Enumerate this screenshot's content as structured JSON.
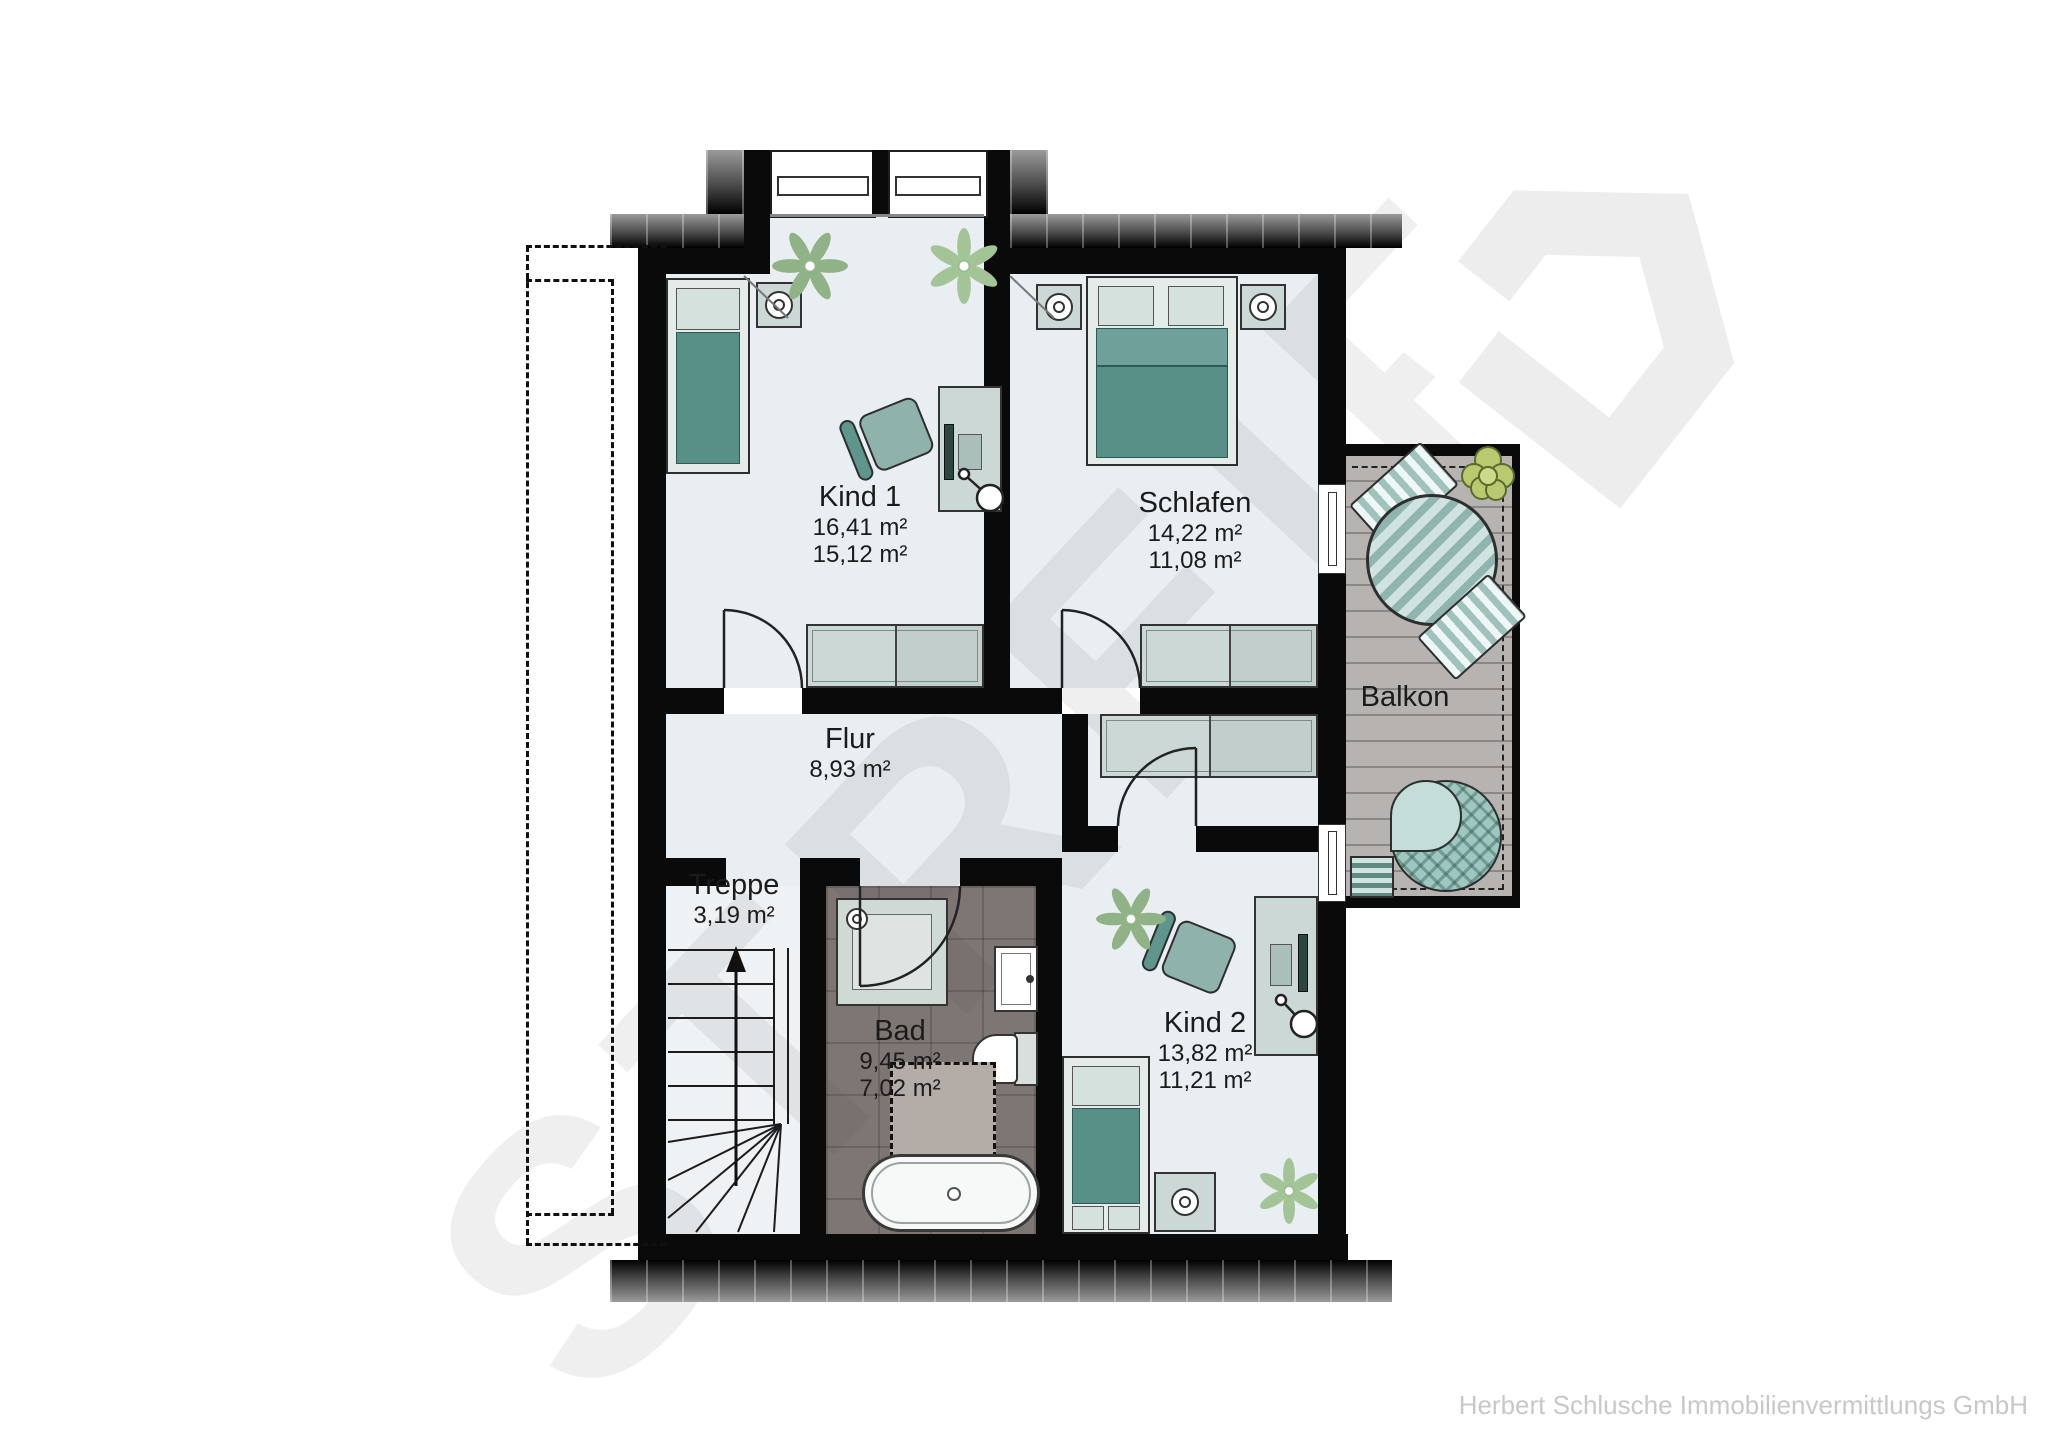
{
  "watermark": {
    "text": "STREIF"
  },
  "footer": {
    "company": "Herbert Schlusche Immobilienvermittlungs GmbH"
  },
  "rooms": [
    {
      "id": "kind1",
      "name": "Kind 1",
      "area_total": "16,41 m²",
      "area_living": "15,12 m²"
    },
    {
      "id": "schlafen",
      "name": "Schlafen",
      "area_total": "14,22 m²",
      "area_living": "11,08 m²"
    },
    {
      "id": "flur",
      "name": "Flur",
      "area_total": "8,93 m²"
    },
    {
      "id": "treppe",
      "name": "Treppe",
      "area_total": "3,19 m²"
    },
    {
      "id": "bad",
      "name": "Bad",
      "area_total": "9,45 m²",
      "area_living": "7,02 m²"
    },
    {
      "id": "kind2",
      "name": "Kind 2",
      "area_total": "13,82 m²",
      "area_living": "11,21 m²"
    },
    {
      "id": "balkon",
      "name": "Balkon"
    }
  ],
  "icons": {
    "stairs_direction": "up-arrow"
  },
  "colors": {
    "wall": "#0a0a0a",
    "room_floor": "#e8eef1",
    "bath_floor": "#7e7672",
    "balcony_deck": "#b4b1ae",
    "furniture_teal": "#579087",
    "furniture_light": "#ccd8d5",
    "watermark_gray": "#ededed"
  }
}
